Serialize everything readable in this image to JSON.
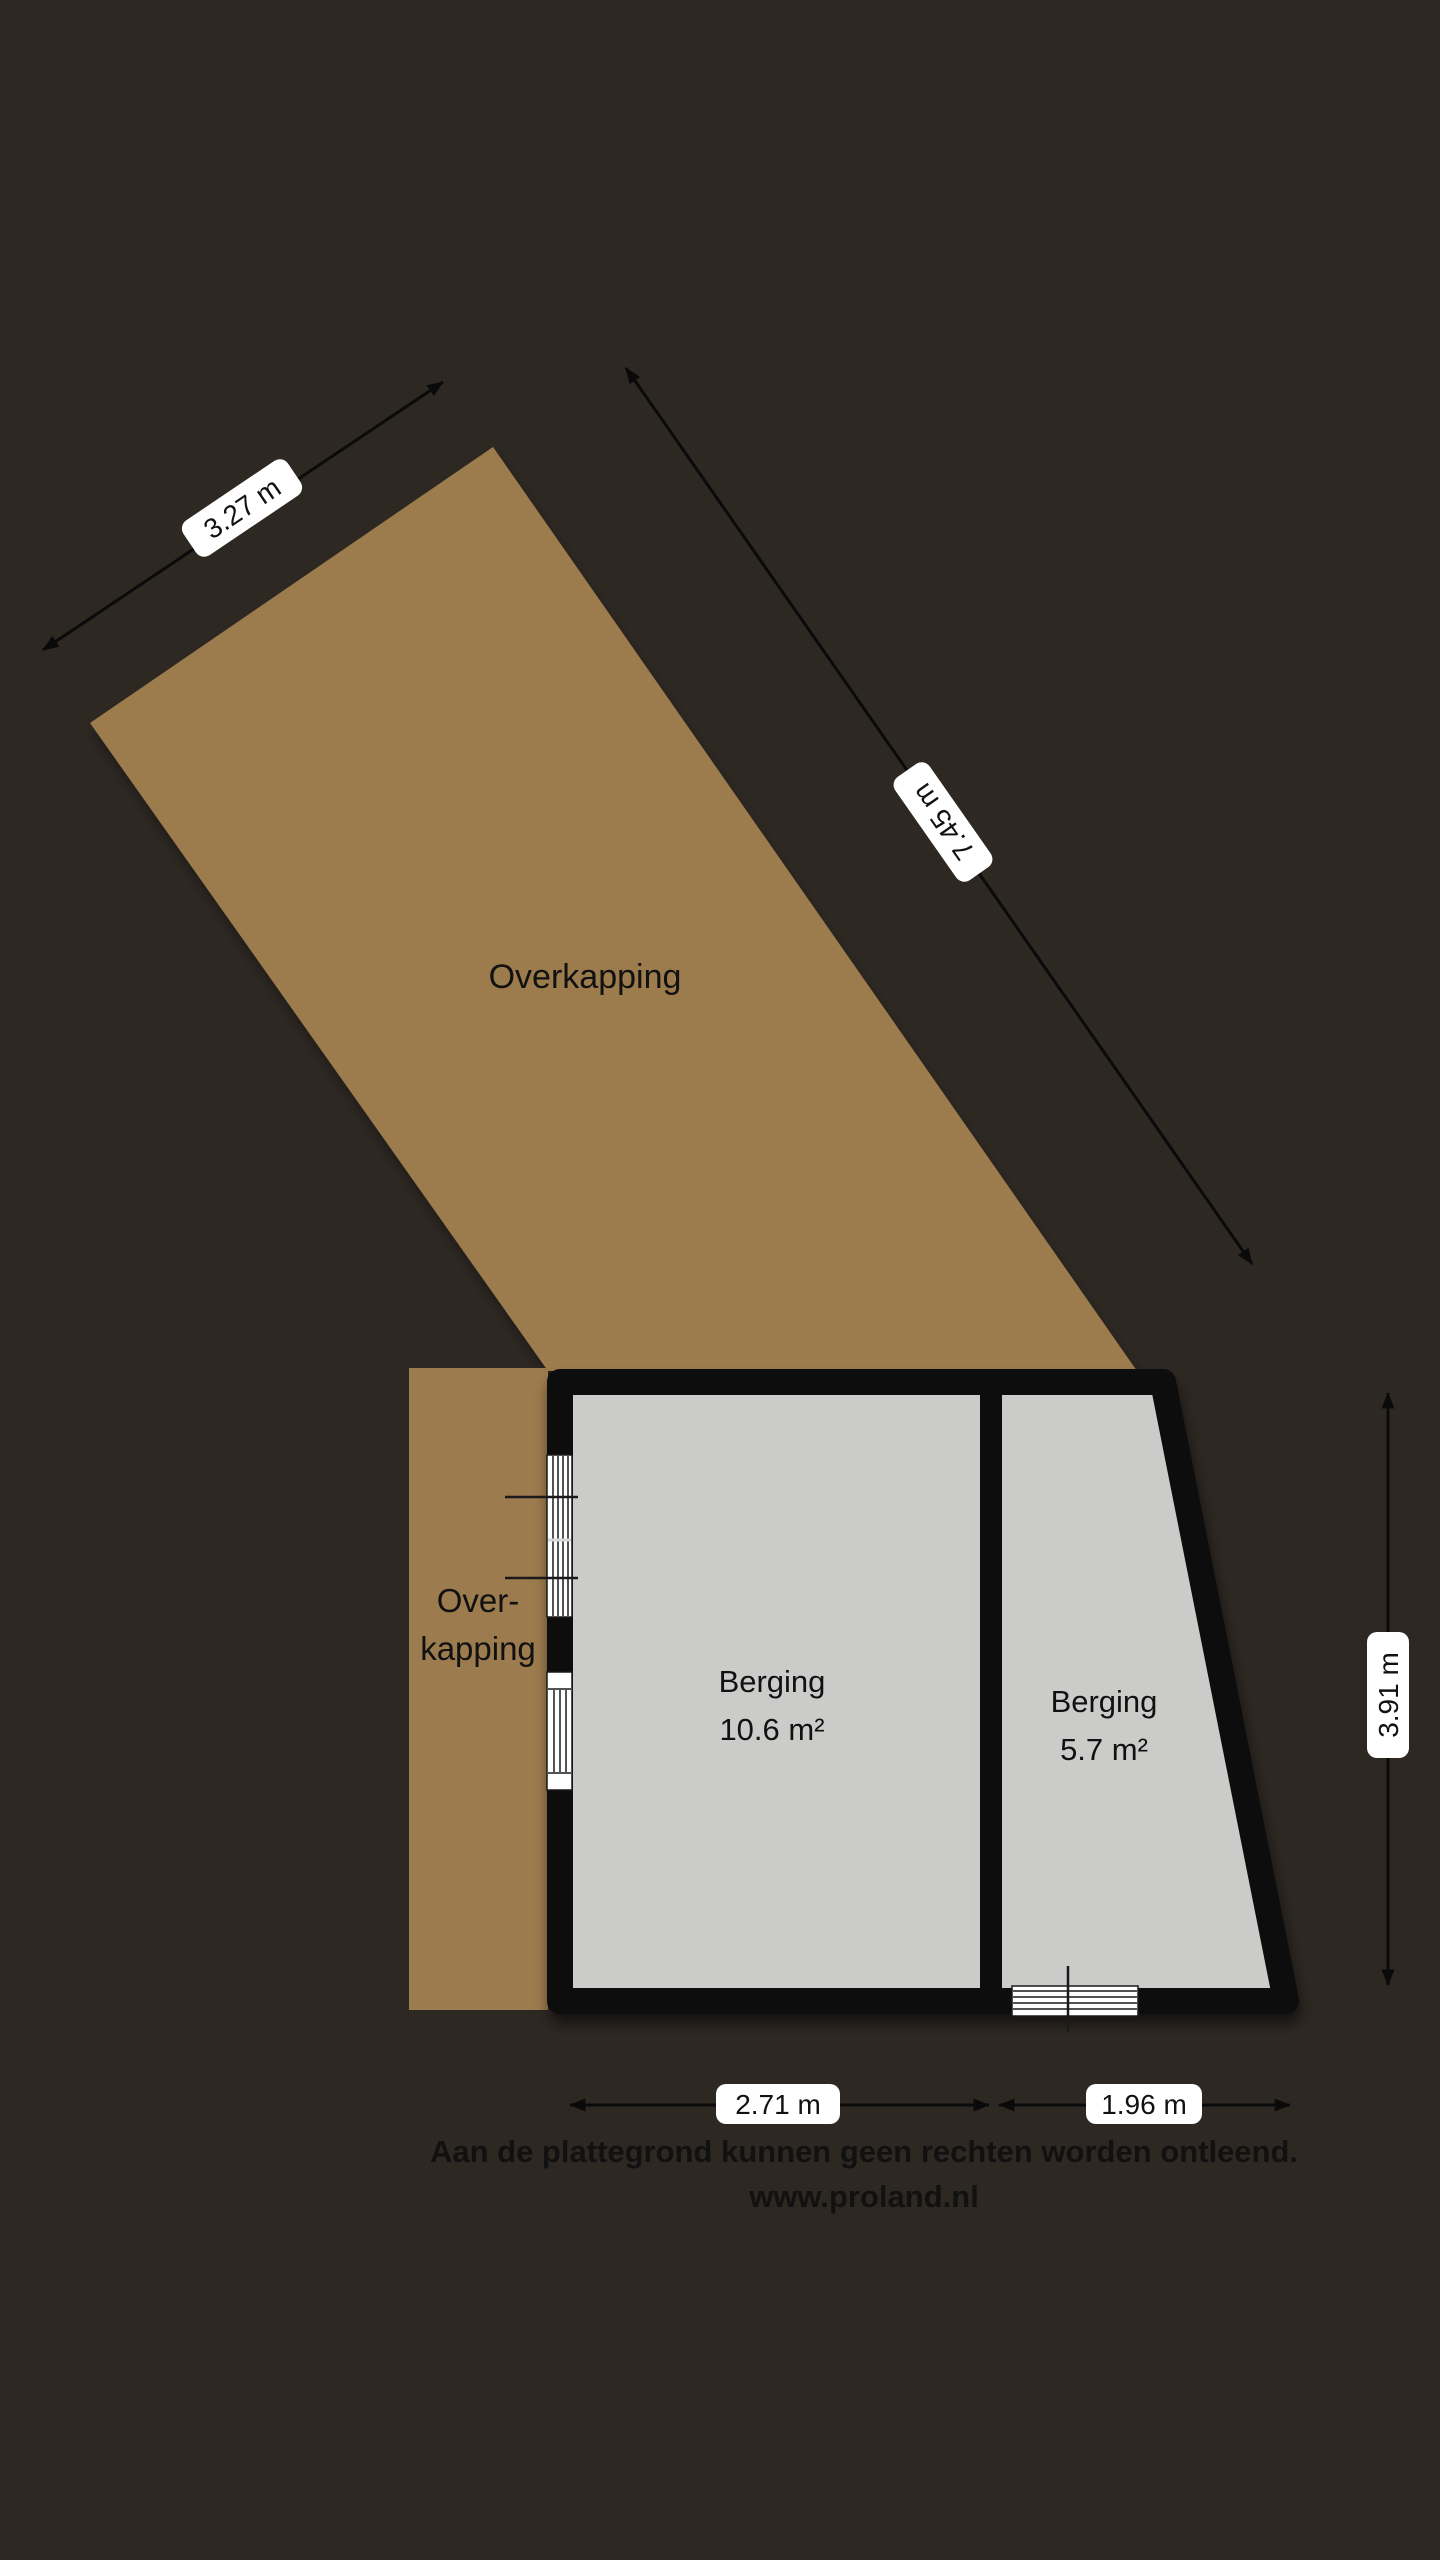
{
  "plan": {
    "canopy_label": "Overkapping",
    "side_canopy": {
      "line1": "Over-",
      "line2": "kapping"
    },
    "rooms": [
      {
        "name": "Berging",
        "area": "10.6 m²"
      },
      {
        "name": "Berging",
        "area": "5.7 m²"
      }
    ],
    "dimensions": {
      "canopy_width": "3.27 m",
      "canopy_length": "7.45 m",
      "building_depth": "3.91 m",
      "room1_width": "2.71 m",
      "room2_width": "1.96 m"
    },
    "disclaimer": {
      "line1": "Aan de plattegrond kunnen geen rechten worden ontleend.",
      "line2": "www.proland.nl"
    },
    "colors": {
      "background": "#2e2823",
      "canopy": "#9c7b4e",
      "wall": "#0a0a0a",
      "floor": "#cbcbca",
      "label_bg": "#ffffff",
      "text": "#111111"
    }
  }
}
